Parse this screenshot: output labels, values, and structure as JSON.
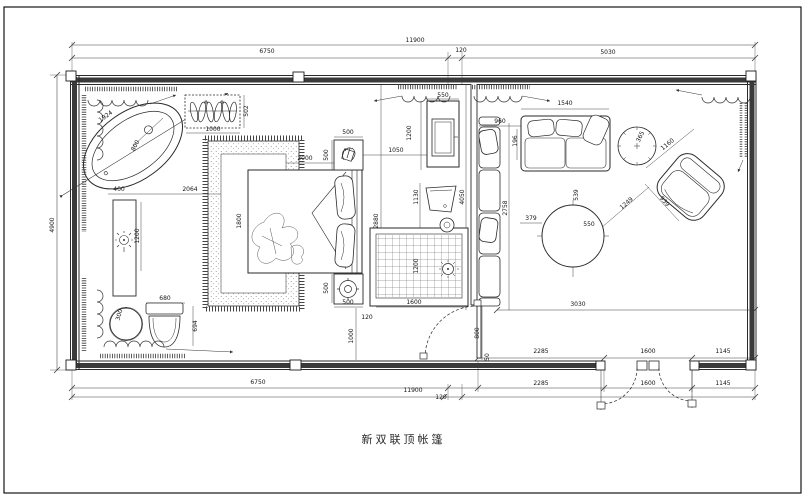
{
  "title": "新双联顶帐篷",
  "colors": {
    "ink": "#2a2a2a",
    "wall_fill": "#3a3a3a",
    "paper": "#ffffff"
  },
  "dim_labels": [
    {
      "t": "11900",
      "x": 415,
      "y": 41,
      "r": 0
    },
    {
      "t": "6750",
      "x": 267,
      "y": 52,
      "r": 0
    },
    {
      "t": "120",
      "x": 461,
      "y": 51,
      "r": 0
    },
    {
      "t": "5030",
      "x": 608,
      "y": 53,
      "r": 0
    },
    {
      "t": "4900",
      "x": 53,
      "y": 225,
      "r": -90
    },
    {
      "t": "1924",
      "x": 106,
      "y": 117,
      "r": -35
    },
    {
      "t": "800",
      "x": 136,
      "y": 146,
      "r": -62
    },
    {
      "t": "502",
      "x": 247,
      "y": 111,
      "r": -90
    },
    {
      "t": "1000",
      "x": 213,
      "y": 130,
      "r": 0
    },
    {
      "t": "400",
      "x": 119,
      "y": 190,
      "r": 0
    },
    {
      "t": "2064",
      "x": 190,
      "y": 190,
      "r": 0
    },
    {
      "t": "1200",
      "x": 138,
      "y": 236,
      "r": -90
    },
    {
      "t": "300",
      "x": 120,
      "y": 315,
      "r": -75
    },
    {
      "t": "680",
      "x": 165,
      "y": 299,
      "r": 0
    },
    {
      "t": "694",
      "x": 196,
      "y": 326,
      "r": -90
    },
    {
      "t": "2000",
      "x": 305,
      "y": 159,
      "r": 0
    },
    {
      "t": "500",
      "x": 327,
      "y": 155,
      "r": -90
    },
    {
      "t": "500",
      "x": 348,
      "y": 133,
      "r": 0
    },
    {
      "t": "1800",
      "x": 240,
      "y": 221,
      "r": -90
    },
    {
      "t": "2880",
      "x": 377,
      "y": 221,
      "r": -90
    },
    {
      "t": "500",
      "x": 327,
      "y": 288,
      "r": -90
    },
    {
      "t": "500",
      "x": 348,
      "y": 303,
      "r": 0
    },
    {
      "t": "120",
      "x": 367,
      "y": 318,
      "r": 0
    },
    {
      "t": "1000",
      "x": 352,
      "y": 336,
      "r": -90
    },
    {
      "t": "1200",
      "x": 417,
      "y": 266,
      "r": -90
    },
    {
      "t": "1600",
      "x": 414,
      "y": 303,
      "r": 0
    },
    {
      "t": "550",
      "x": 443,
      "y": 96,
      "r": 0
    },
    {
      "t": "1200",
      "x": 410,
      "y": 133,
      "r": -90
    },
    {
      "t": "1050",
      "x": 396,
      "y": 151,
      "r": 0
    },
    {
      "t": "1130",
      "x": 417,
      "y": 197,
      "r": -90
    },
    {
      "t": "4050",
      "x": 463,
      "y": 197,
      "r": -90
    },
    {
      "t": "960",
      "x": 500,
      "y": 122,
      "r": 0
    },
    {
      "t": "196",
      "x": 516,
      "y": 141,
      "r": -90
    },
    {
      "t": "1540",
      "x": 565,
      "y": 104,
      "r": 0
    },
    {
      "t": "365",
      "x": 641,
      "y": 137,
      "r": -65
    },
    {
      "t": "1160",
      "x": 668,
      "y": 145,
      "r": -40
    },
    {
      "t": "939",
      "x": 664,
      "y": 202,
      "r": 48
    },
    {
      "t": "1249",
      "x": 627,
      "y": 204,
      "r": -41
    },
    {
      "t": "2758",
      "x": 506,
      "y": 208,
      "r": -90
    },
    {
      "t": "379",
      "x": 531,
      "y": 219,
      "r": 0
    },
    {
      "t": "539",
      "x": 577,
      "y": 195,
      "r": -90
    },
    {
      "t": "550",
      "x": 589,
      "y": 225,
      "r": 0
    },
    {
      "t": "3030",
      "x": 578,
      "y": 305,
      "r": 0
    },
    {
      "t": "800",
      "x": 478,
      "y": 333,
      "r": -90
    },
    {
      "t": "50",
      "x": 488,
      "y": 357,
      "r": -90
    },
    {
      "t": "2285",
      "x": 541,
      "y": 352,
      "r": 0
    },
    {
      "t": "1600",
      "x": 648,
      "y": 352,
      "r": 0
    },
    {
      "t": "1145",
      "x": 723,
      "y": 352,
      "r": 0
    },
    {
      "t": "6750",
      "x": 258,
      "y": 383,
      "r": 0
    },
    {
      "t": "2285",
      "x": 541,
      "y": 384,
      "r": 0
    },
    {
      "t": "1600",
      "x": 648,
      "y": 384,
      "r": 0
    },
    {
      "t": "1145",
      "x": 723,
      "y": 384,
      "r": 0
    },
    {
      "t": "11900",
      "x": 413,
      "y": 391,
      "r": 0
    },
    {
      "t": "120",
      "x": 441,
      "y": 398,
      "r": 0
    }
  ]
}
